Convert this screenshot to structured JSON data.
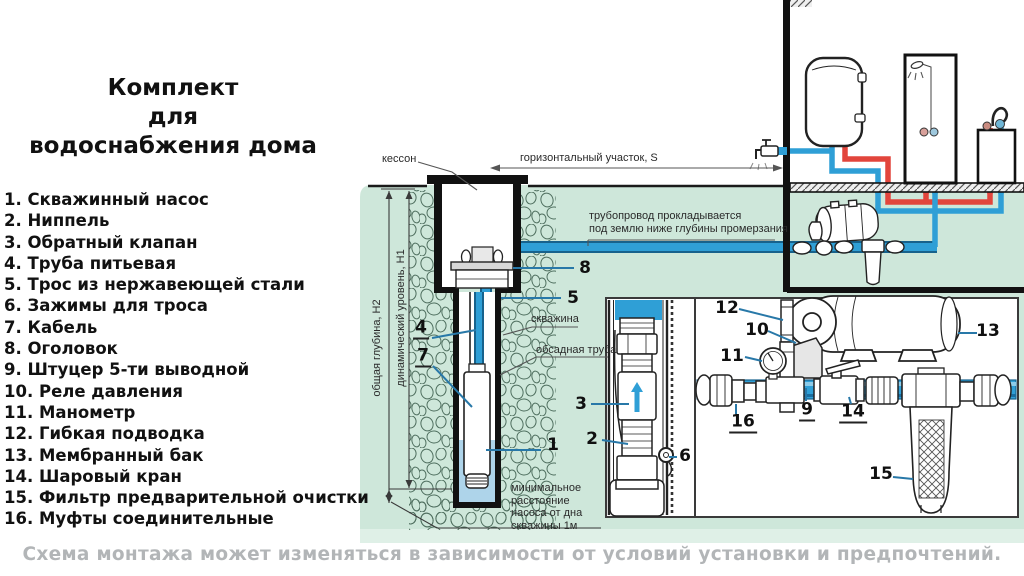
{
  "title_lines": [
    "Комплект",
    "для",
    "водоснабжения дома"
  ],
  "legend": {
    "items": [
      "1. Скважинный насос",
      "2. Ниппель",
      "3. Обратный клапан",
      "4. Труба питьевая",
      "5. Трос из нержавеющей стали",
      "6. Зажимы для троса",
      "7. Кабель",
      "8. Оголовок",
      "9. Штуцер 5-ти выводной",
      "10. Реле давления",
      "11. Манометр",
      "12. Гибкая подводка",
      "13. Мембранный бак",
      "14. Шаровый кран",
      "15. Фильтр предварительной очистки",
      "16. Муфты соединительные"
    ]
  },
  "diagram": {
    "labels": {
      "kesson": "кессон",
      "horizontal_section": "горизонтальный участок, S",
      "pipeline_note": "трубопровод прокладывается\nпод землю ниже глубины промерзания",
      "total_depth": "общая глубина, Н2",
      "dynamic_level": "динамический уровень, Н1",
      "borehole": "скважина",
      "casing_pipe": "обсадная труба",
      "min_distance": "минимальное\nрасстояние\nнасоса от дна\nскважины 1м"
    },
    "callouts": {
      "n1": "1",
      "n2": "2",
      "n3": "3",
      "n4": "4",
      "n5": "5",
      "n6": "6",
      "n7": "7",
      "n8": "8",
      "n9": "9",
      "n10": "10",
      "n11": "11",
      "n12": "12",
      "n13": "13",
      "n14": "14",
      "n15": "15",
      "n16": "16"
    }
  },
  "caption": "Схема монтажа может изменяться в зависимости от условий установки и предпочтений.",
  "colors": {
    "ground_green": "#cee7da",
    "ground_light_strip": "#dff0e7",
    "pipe_blue": "#2f9fd6",
    "pipe_red": "#e2453c",
    "leader_blue": "#2878a8",
    "caption_gray": "#b2b5b7"
  }
}
